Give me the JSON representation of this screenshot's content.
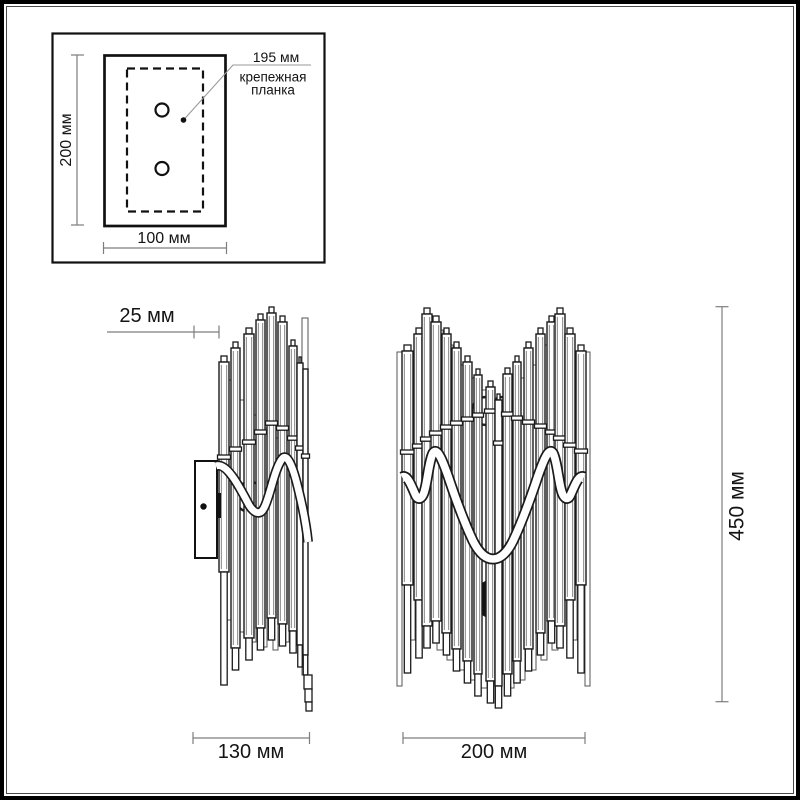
{
  "inset": {
    "height_label": "200 мм",
    "width_label": "100 мм",
    "callout_value": "195 мм",
    "callout_caption_line1": "крепежная",
    "callout_caption_line2": "планка"
  },
  "side_view": {
    "depth_label": "25 мм",
    "width_label": "130 мм"
  },
  "front_view": {
    "width_label": "200 мм",
    "height_label": "450 мм"
  },
  "colors": {
    "outline": "#1a1a1a",
    "dimension_line": "#7d7d7d",
    "text": "#141414",
    "background": "#ffffff",
    "frame": "#000000"
  }
}
